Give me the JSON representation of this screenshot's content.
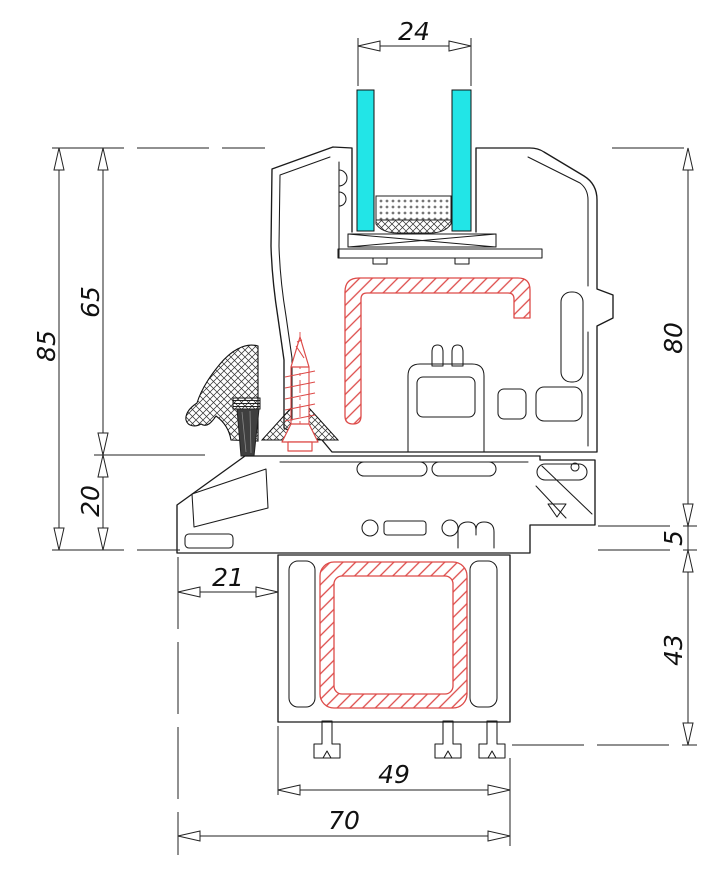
{
  "drawing": {
    "type": "window-profile-cross-section",
    "dimensions": {
      "glazing_thickness": "24",
      "total_height_left": "85",
      "sash_height_left": "65",
      "frame_rebate_height": "20",
      "sash_frame_height_right": "80",
      "joint_gap": "5",
      "extension_profile_height": "43",
      "frame_edge_width": "21",
      "extension_width": "49",
      "frame_total_width": "70"
    },
    "colors": {
      "glass": "#22e5e7",
      "steel": "#dd4a48",
      "line": "#1b1b1b",
      "gasket": "#3f3f3f",
      "dimline": "#222222"
    }
  }
}
